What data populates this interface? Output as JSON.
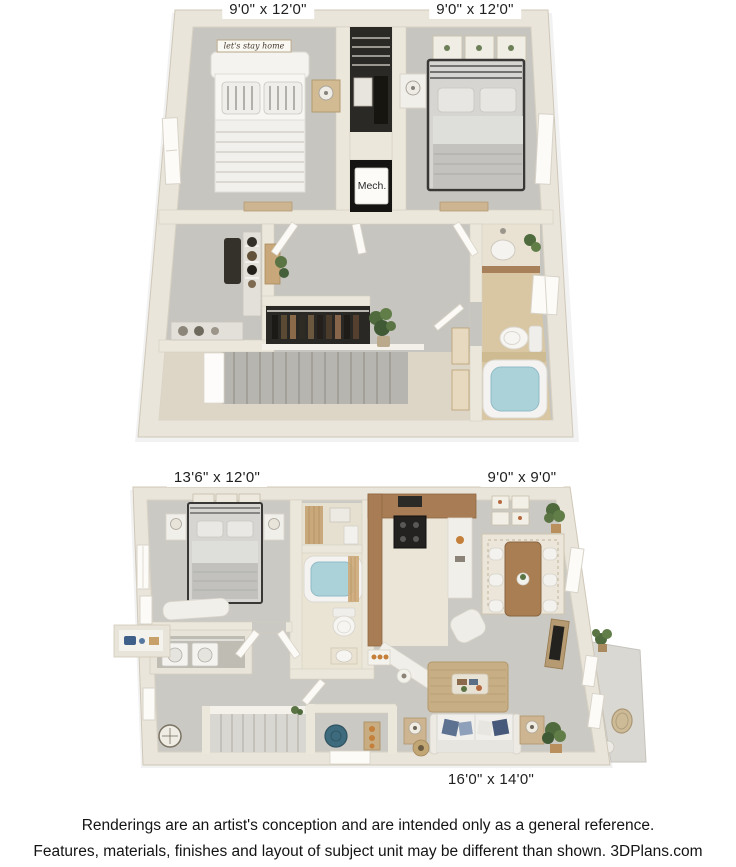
{
  "floor2": {
    "label_bedroom_left": "9'0\" x 12'0\"",
    "label_bedroom_right": "9'0\" x 12'0\"",
    "label_mech": "Mech.",
    "label_wall_sign": "let's stay home"
  },
  "floor1": {
    "label_bedroom": "13'6\" x 12'0\"",
    "label_dining": "9'0\" x 9'0\"",
    "label_living": "16'0\" x 14'0\""
  },
  "footer": {
    "line1": "Renderings are an artist's conception and are intended only as a general reference.",
    "line2": "Features, materials, finishes and layout of subject unit may be different than shown. 3DPlans.com"
  },
  "colors": {
    "wall": "#eae5da",
    "wall_edge": "#cfc8b8",
    "carpet": "#c7c5bf",
    "landing_floor": "#ddd6c6",
    "tile_tan": "#d9c6a2",
    "tile_cream": "#eae4d4",
    "wood": "#a87c54",
    "wood_light": "#cdb591",
    "water_blue": "#abd1d9",
    "closet_dark": "#262421",
    "stairs_gray": "#b7b5af",
    "patio_gray": "#dad8d3",
    "plant_green": "#4f6a3c",
    "pillow_blue": "#5d7191",
    "text": "#141414"
  }
}
